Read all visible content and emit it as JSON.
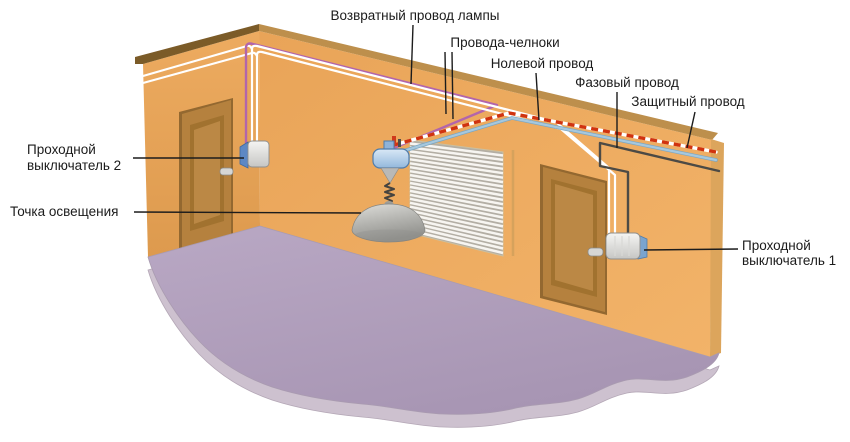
{
  "diagram_title": "Схема подключения проходных выключателей (освещение комнаты)",
  "labels": {
    "lamp_return": "Возвратный провод лампы",
    "travellers": "Провода-челноки",
    "neutral": "Нолевой провод",
    "phase": "Фазовый провод",
    "protective": "Защитный провод",
    "switch2": [
      "Проходной",
      "выключатель 2"
    ],
    "lighting_point": "Точка освещения",
    "switch1": [
      "Проходной",
      "выключатель 1"
    ]
  },
  "colors": {
    "lamp_return_wire": "#b265ab",
    "traveller_wire": "#ffffff",
    "neutral_wire": "#a6c8de",
    "phase_wire": "#4c4a45",
    "protective_wire_base": "#ffffff",
    "protective_wire_dash": "#d0330f",
    "wall": "#eba85e",
    "floor": "#b1a0bd"
  }
}
